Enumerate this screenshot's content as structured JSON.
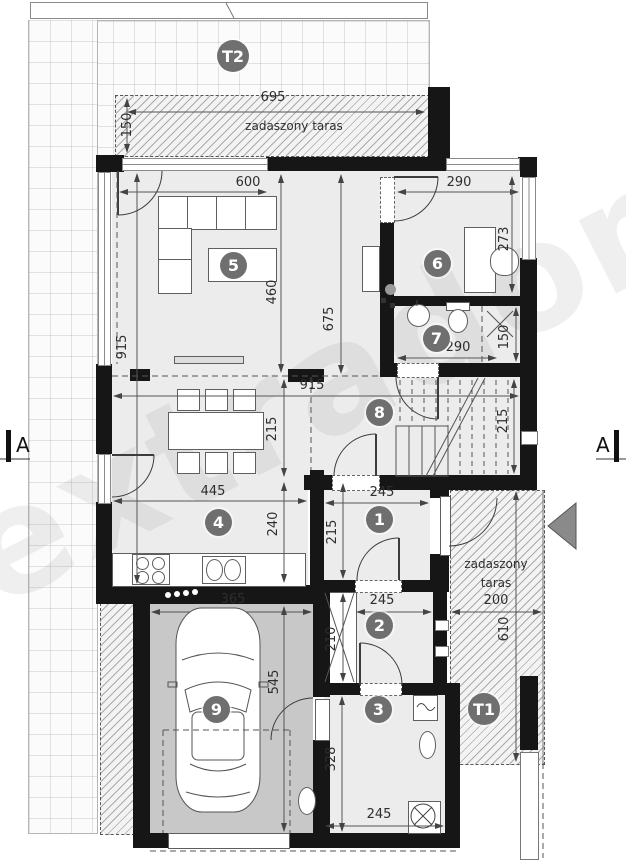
{
  "labels": {
    "watermark": "extradom",
    "section": "A",
    "t1_badge": "T1",
    "t2_badge": "T2",
    "terrace_top_label": "zadaszony taras",
    "terrace_right_label_1": "zadaszony",
    "terrace_right_label_2": "taras"
  },
  "rooms": {
    "r1": "1",
    "r2": "2",
    "r3": "3",
    "r4": "4",
    "r5": "5",
    "r6": "6",
    "r7": "7",
    "r8": "8",
    "r9": "9"
  },
  "dims": {
    "t2w": "695",
    "t2d": "150",
    "r5w": "600",
    "r5d": "460",
    "r5d2": "675",
    "left_total": "915",
    "r6w": "290",
    "r6d": "273",
    "r7w": "290",
    "r7d": "150",
    "hallw": "915",
    "halld": "215",
    "dining_d": "215",
    "kitw": "445",
    "kitd": "240",
    "r1w": "245",
    "r1d": "215",
    "r2w": "245",
    "r2d": "210",
    "r3w": "245",
    "r3d": "328",
    "r9w": "365",
    "r9d": "545",
    "trw": "200",
    "trd": "610"
  }
}
